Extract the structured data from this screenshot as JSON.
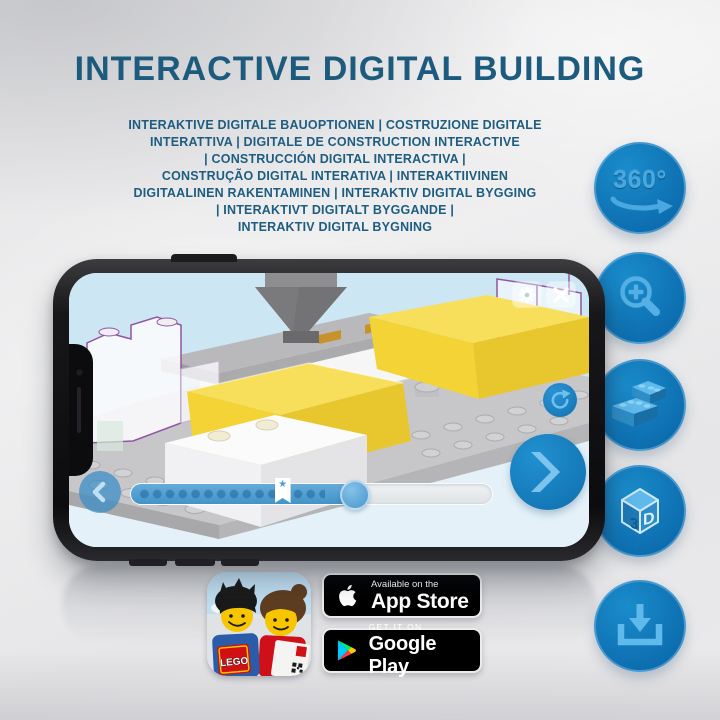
{
  "title": "INTERACTIVE DIGITAL BUILDING",
  "subtitle_lines": [
    "INTERAKTIVE DIGITALE BAUOPTIONEN | COSTRUZIONE DIGITALE",
    "INTERATTIVA | DIGITALE DE CONSTRUCTION INTERACTIVE",
    "| CONSTRUCCIÓN DIGITAL INTERACTIVA |",
    "CONSTRUÇÃO DIGITAL INTERATIVA | INTERAKTIIVINEN",
    "DIGITAALINEN RAKENTAMINEN | INTERAKTIV DIGITAL BYGGING",
    "| INTERAKTIVT DIGITALT BYGGANDE |",
    "INTERAKTIV DIGITAL BYGNING"
  ],
  "feature_icons": [
    {
      "name": "360-rotation-icon",
      "label": "360°"
    },
    {
      "name": "zoom-in-icon"
    },
    {
      "name": "lego-bricks-icon"
    },
    {
      "name": "3d-cube-icon",
      "left": "3",
      "right": "D"
    },
    {
      "name": "download-icon"
    }
  ],
  "phone": {
    "progress": {
      "fill_percent": 62,
      "bookmark_percent": 42
    }
  },
  "badges": {
    "lego": {
      "logo_text": "LEGO"
    },
    "app_store": {
      "tagline": "Available on the",
      "store_name": "App Store"
    },
    "google_play": {
      "tagline": "GET IT ON",
      "store_name": "Google Play"
    }
  },
  "colors": {
    "title_blue": "#1d5b7e",
    "feature_circle_blue": "#0f76ba",
    "feature_glyph_blue": "#49a8e0",
    "app_ui_blue": "#2a8cc8",
    "brick_yellow": "#f3d435",
    "ghost_outline_purple": "#8f55a2",
    "sky_blue": "#cfe7f5",
    "badge_black": "#000000"
  }
}
